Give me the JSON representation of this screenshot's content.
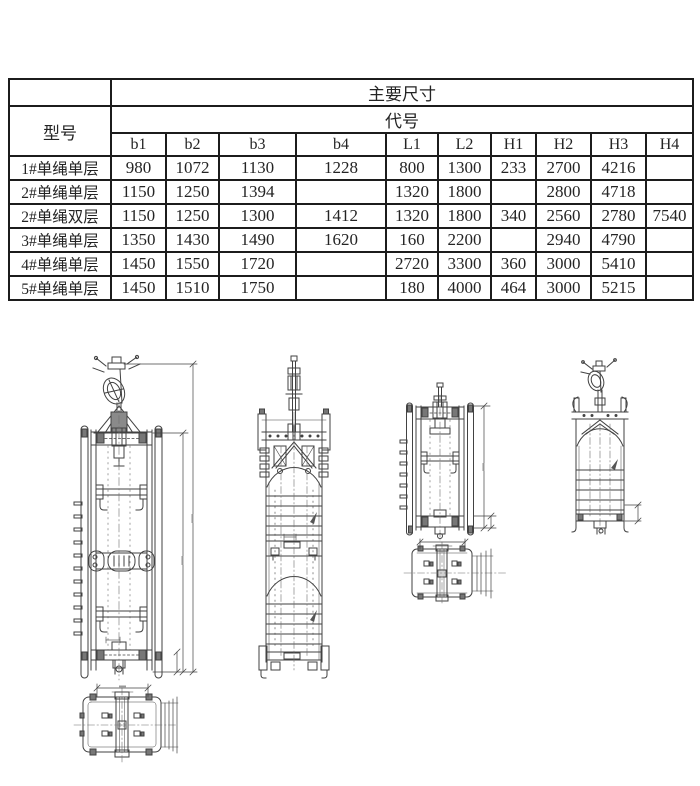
{
  "table": {
    "corner_label": "",
    "model_label": "型号",
    "main_dims_label": "主要尺寸",
    "code_label": "代号",
    "columns": [
      "b1",
      "b2",
      "b3",
      "b4",
      "L1",
      "L2",
      "H1",
      "H2",
      "H3",
      "H4"
    ],
    "rows": [
      {
        "model": "1#单绳单层",
        "values": [
          "980",
          "1072",
          "1130",
          "1228",
          "800",
          "1300",
          "233",
          "2700",
          "4216",
          ""
        ]
      },
      {
        "model": "2#单绳单层",
        "values": [
          "1150",
          "1250",
          "1394",
          "",
          "1320",
          "1800",
          "",
          "2800",
          "4718",
          ""
        ]
      },
      {
        "model": "2#单绳双层",
        "values": [
          "1150",
          "1250",
          "1300",
          "1412",
          "1320",
          "1800",
          "340",
          "2560",
          "2780",
          "7540"
        ]
      },
      {
        "model": "3#单绳单层",
        "values": [
          "1350",
          "1430",
          "1490",
          "1620",
          "160",
          "2200",
          "",
          "2940",
          "4790",
          ""
        ]
      },
      {
        "model": "4#单绳单层",
        "values": [
          "1450",
          "1550",
          "1720",
          "",
          "2720",
          "3300",
          "360",
          "3000",
          "5410",
          ""
        ]
      },
      {
        "model": "5#单绳单层",
        "values": [
          "1450",
          "1510",
          "1750",
          "",
          "180",
          "4000",
          "464",
          "3000",
          "5215",
          ""
        ]
      }
    ]
  },
  "drawings": {
    "items": [
      {
        "name": "cage-front-view-large"
      },
      {
        "name": "cage-side-view-double-deck"
      },
      {
        "name": "cage-front-view-small"
      },
      {
        "name": "cage-plan-view-right"
      },
      {
        "name": "cage-side-view-short"
      },
      {
        "name": "cage-plan-view-bottom-left"
      }
    ]
  },
  "colors": {
    "table_border": "#1c1c1c",
    "text": "#242424",
    "drawing_line": "#424242",
    "background": "#ffffff"
  }
}
